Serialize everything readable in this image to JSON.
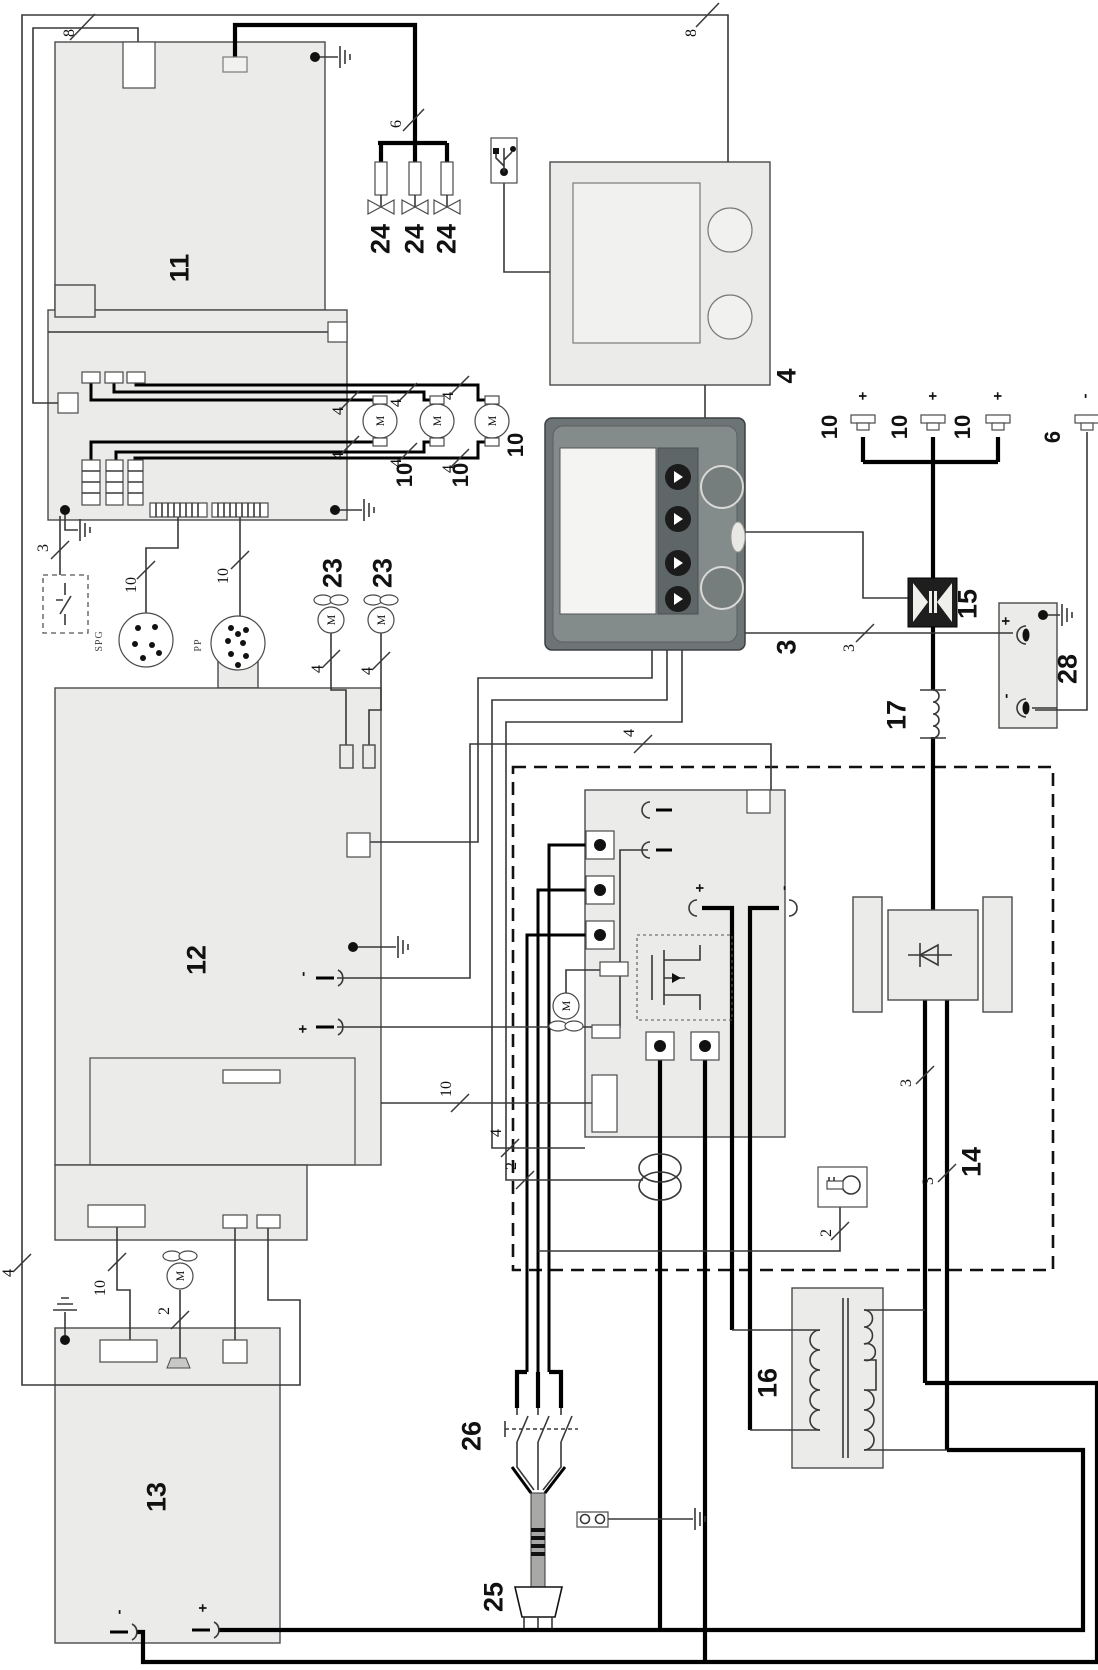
{
  "diagram": {
    "kind": "patent-wiring-schematic",
    "orientation": "labels rotated 90deg counter-clockwise"
  },
  "colors": {
    "box_fill": "#ebebe9",
    "thin_wire": "#383838",
    "thick_wire": "#000000",
    "display_body": "#6d7476",
    "display_panel": "#848b8b",
    "screen": "#f4f4f2"
  },
  "labels": {
    "n2": "2",
    "n3": "3",
    "n4": "4",
    "n6": "6",
    "n8": "8",
    "n10": "10",
    "n11": "11",
    "n12": "12",
    "n13": "13",
    "n14": "14",
    "n15": "15",
    "n16": "16",
    "n17": "17",
    "n23": "23",
    "n24": "24",
    "n25": "25",
    "n26": "26",
    "n28": "28",
    "motor": "M",
    "conn_spg": "SPG",
    "conn_pp": "PP",
    "plus": "+",
    "minus": "-"
  }
}
